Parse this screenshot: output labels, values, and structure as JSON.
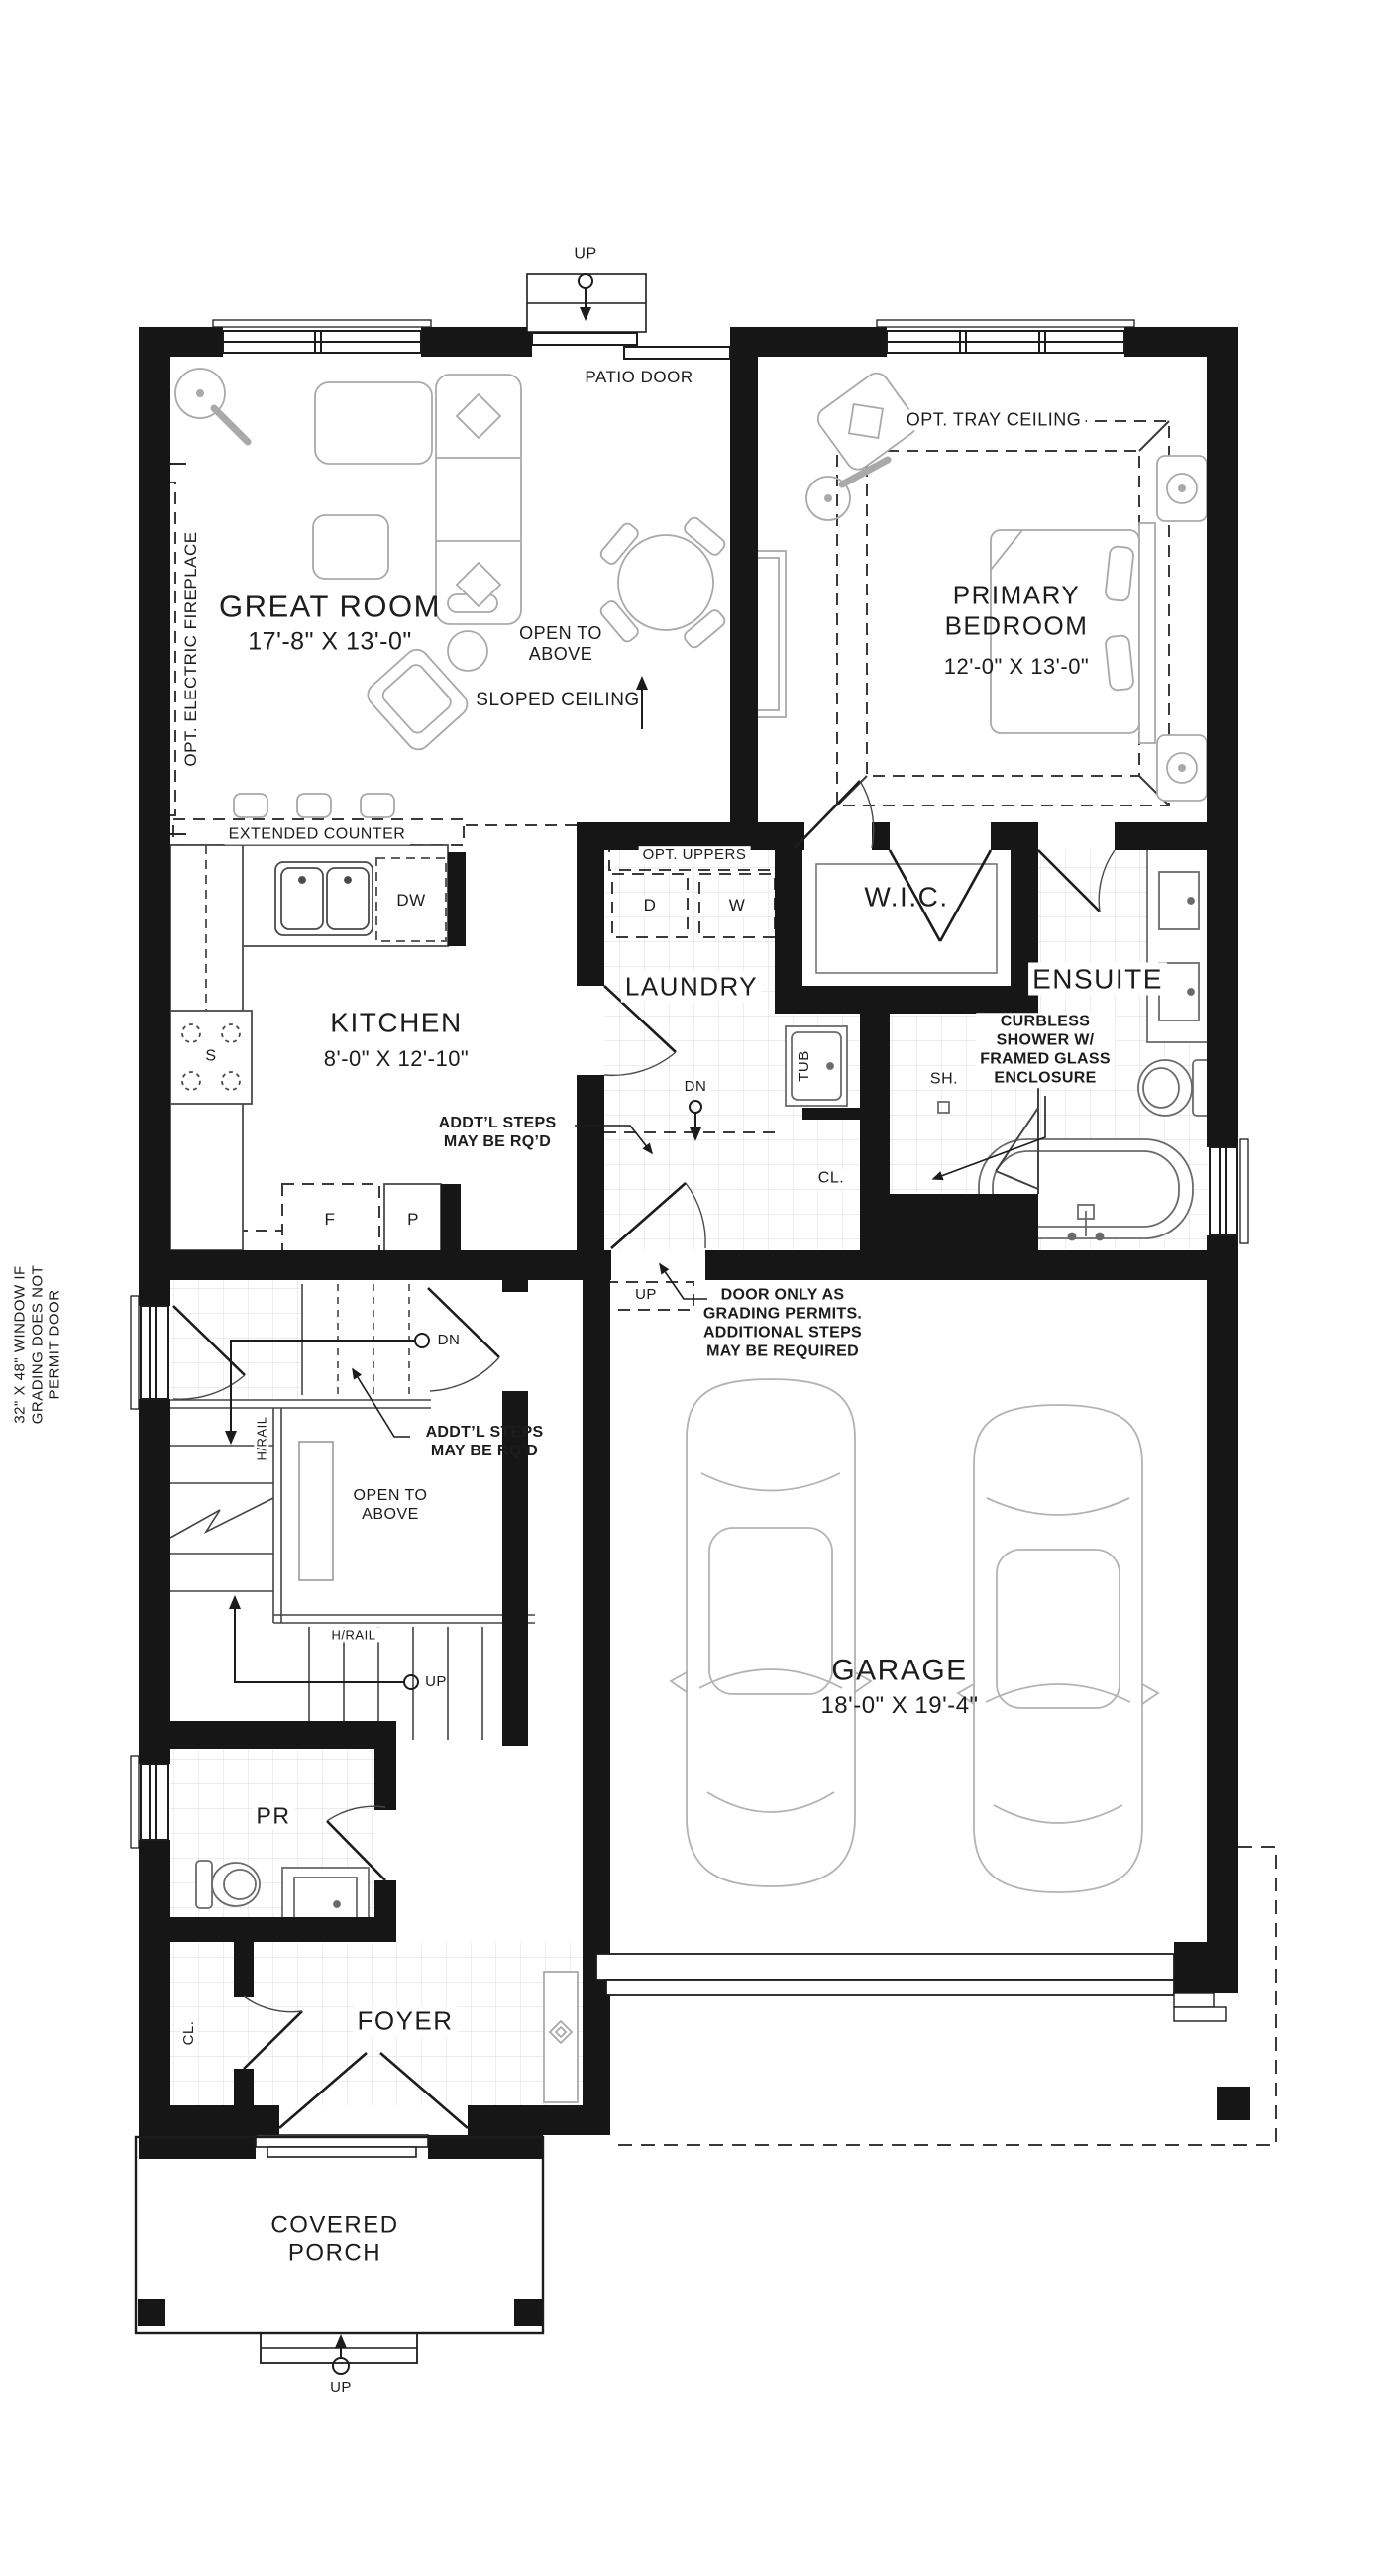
{
  "colors": {
    "wall": "#161616",
    "line": "#2a2a2a",
    "furniture": "#a9a9a9",
    "fixture": "#6b6b6b",
    "tile": "#e2e2e2",
    "text": "#1c1c1c"
  },
  "rooms": {
    "great_room": {
      "name": "GREAT ROOM",
      "dims": "17'-8\" X 13'-0\""
    },
    "primary_bedroom": {
      "name": "PRIMARY\nBEDROOM",
      "dims": "12'-0\" X 13'-0\""
    },
    "kitchen": {
      "name": "KITCHEN",
      "dims": "8'-0\" X 12'-10\""
    },
    "laundry": {
      "name": "LAUNDRY"
    },
    "wic": {
      "name": "W.I.C."
    },
    "ensuite": {
      "name": "ENSUITE"
    },
    "garage": {
      "name": "GARAGE",
      "dims": "18'-0\" X 19'-4\""
    },
    "powder_room": {
      "name": "PR"
    },
    "foyer": {
      "name": "FOYER"
    },
    "covered_porch": {
      "name": "COVERED\nPORCH"
    }
  },
  "annotations": {
    "up_patio": "UP",
    "patio_door": "PATIO DOOR",
    "opt_electric_fireplace": "OPT. ELECTRIC FIREPLACE",
    "open_to_above_great": "OPEN TO\nABOVE",
    "sloped_ceiling": "SLOPED CEILING",
    "opt_tray_ceiling": "OPT. TRAY CEILING",
    "extended_counter": "EXTENDED COUNTER",
    "dishwasher": "DW",
    "stove": "S",
    "fridge": "F",
    "pantry": "P",
    "addtl_steps_kitchen": "ADDT’L STEPS\nMAY BE RQ’D",
    "opt_uppers": "OPT. UPPERS",
    "dryer": "D",
    "washer": "W",
    "dn_laundry": "DN",
    "tub": "TUB",
    "shower": "SH.",
    "closet_hall": "CL.",
    "curbless_shower": "CURBLESS\nSHOWER W/\nFRAMED GLASS\nENCLOSURE",
    "window_grading_note": "32\" X 48\" WINDOW IF\nGRADING DOES NOT\nPERMIT DOOR",
    "dn_stairs": "DN",
    "handrail_vertical": "H/RAIL",
    "addtl_steps_stairs": "ADDT’L STEPS\nMAY BE RQ’D",
    "open_to_above_stairs": "OPEN TO\nABOVE",
    "handrail_horizontal": "H/RAIL",
    "up_stairs": "UP",
    "up_garage_steps": "UP",
    "door_grading_note": "DOOR ONLY AS\nGRADING PERMITS.\nADDITIONAL STEPS\nMAY BE REQUIRED",
    "closet_foyer": "CL.",
    "up_porch": "UP"
  }
}
